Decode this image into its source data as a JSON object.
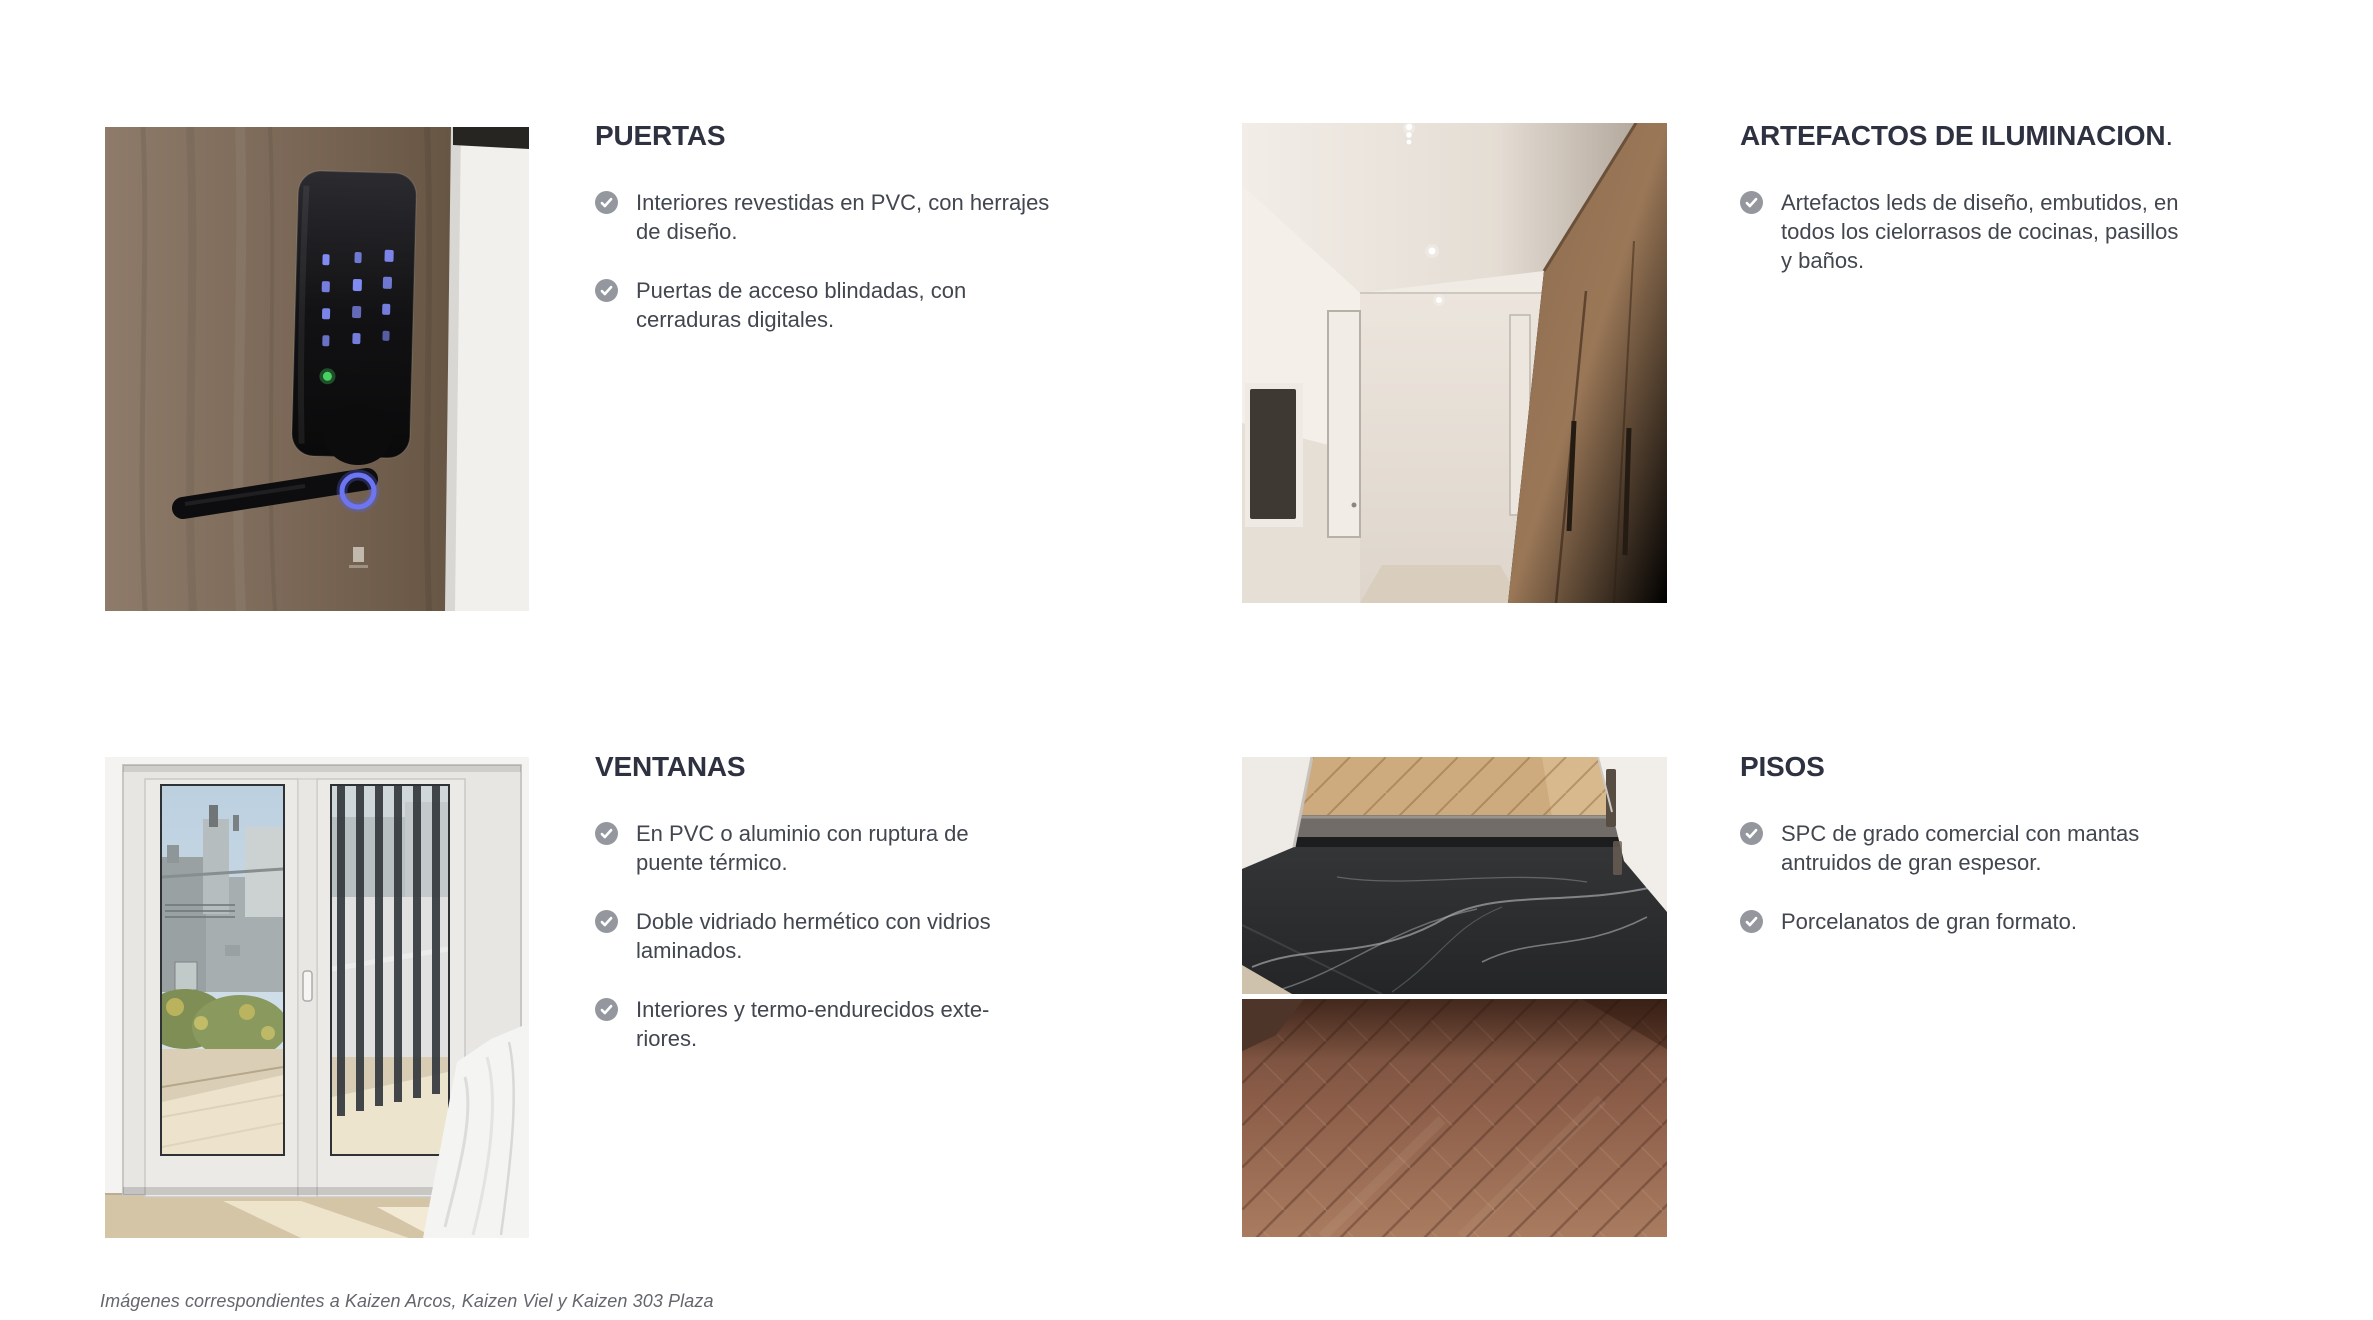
{
  "page_background": "#ffffff",
  "colors": {
    "heading_text": "#2e3140",
    "body_text": "#42464f",
    "bullet_icon_circle": "#94979d",
    "bullet_icon_check": "#ffffff",
    "footer_text": "#63666c"
  },
  "icons": {
    "bullet": "check-circle-icon"
  },
  "sections": [
    {
      "id": "puertas",
      "title": "PUERTAS",
      "title_suffix": "",
      "photo": "smart-lock-on-wooden-door",
      "bullets": [
        {
          "lines": [
            "Interiores revestidas en PVC, con herrajes",
            "de diseño."
          ]
        },
        {
          "lines": [
            "Puertas de acceso blindadas, con",
            "cerraduras digitales."
          ]
        }
      ]
    },
    {
      "id": "artefactos-de-iluminacion",
      "title": "ARTEFACTOS DE ILUMINACION",
      "title_suffix": ".",
      "photo": "hallway-with-recessed-led-lights",
      "bullets": [
        {
          "lines": [
            "Artefactos leds de diseño, embutidos, en",
            "todos los cielorrasos de cocinas, pasillos",
            "y baños."
          ]
        }
      ]
    },
    {
      "id": "ventanas",
      "title": "VENTANAS",
      "title_suffix": "",
      "photo": "pvc-window-with-city-view",
      "bullets": [
        {
          "lines": [
            "En PVC o aluminio con ruptura de",
            "puente térmico."
          ]
        },
        {
          "lines": [
            "Doble vidriado hermético con vidrios",
            "laminados."
          ]
        },
        {
          "lines": [
            "Interiores y termo-endurecidos exte-",
            "riores."
          ]
        }
      ]
    },
    {
      "id": "pisos",
      "title": "PISOS",
      "title_suffix": "",
      "photo": "marble-and-herringbone-wood-floors",
      "bullets": [
        {
          "lines": [
            "SPC de grado comercial con mantas",
            "antruidos de gran espesor."
          ]
        },
        {
          "lines": [
            "Porcelanatos de gran formato."
          ]
        }
      ]
    }
  ],
  "footer": {
    "text": "Imágenes correspondientes a Kaizen Arcos, Kaizen Viel y Kaizen 303 Plaza"
  }
}
